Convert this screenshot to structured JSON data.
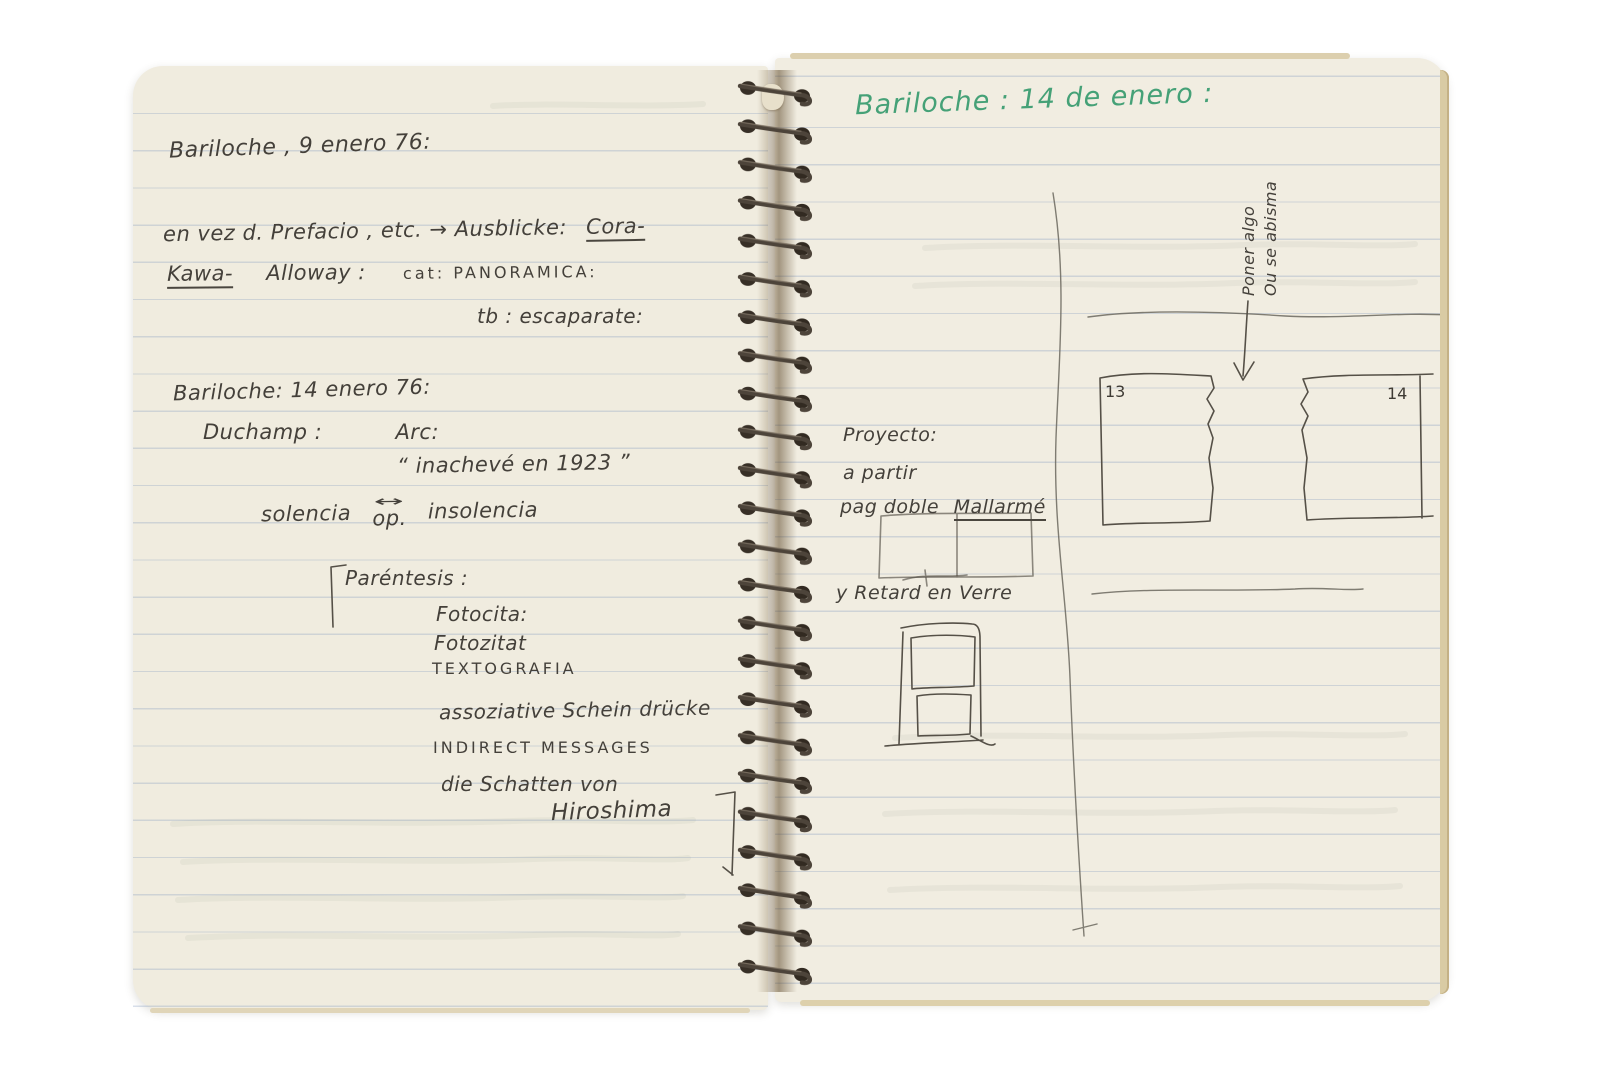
{
  "notebook": {
    "colors": {
      "paper": "#f0ecdf",
      "ink": "#44403a",
      "green_ink": "#45a177",
      "ruled_line": "#8098bc",
      "page_edge": "#d9cba4",
      "spiral_wire": "#4d443a"
    },
    "left_page": {
      "heading": "Bariloche , 9 enero 76:",
      "line2a": "en vez d. Prefacio , etc. → Ausblicke:",
      "line2b": "Cora-",
      "line3a": "Kawa-",
      "line3b": "Alloway :",
      "line3c": "cat: PANORAMICA:",
      "line4": "tb : escaparate:",
      "section2_heading": "Bariloche: 14 enero 76:",
      "duchamp": "Duchamp :",
      "arc": "Arc:",
      "quote": "“ inachevé en 1923 ”",
      "sol_left": "solencia",
      "sol_arrow": "↔",
      "sol_op": "op.",
      "sol_right": "insolencia",
      "parentesis": "Paréntesis :",
      "list1": "Fotocita:",
      "list2": "Fotozitat",
      "list3": "TEXTOGRAFIA",
      "list4": "assoziative Schein drücke",
      "list5": "INDIRECT MESSAGES",
      "list6": "die Schatten von",
      "list7": "Hiroshima"
    },
    "right_page": {
      "heading": "Bariloche : 14 de enero :",
      "rotated_note_line1": "Poner algo",
      "rotated_note_line2": "Ou se abisma",
      "proyecto": "Proyecto:",
      "a_partir": "a partir",
      "pag_doble_a": "pag doble",
      "pag_doble_b": "Mallarmé",
      "retard": "y Retard en Verre",
      "page_label_13": "13",
      "page_label_14": "14"
    }
  }
}
